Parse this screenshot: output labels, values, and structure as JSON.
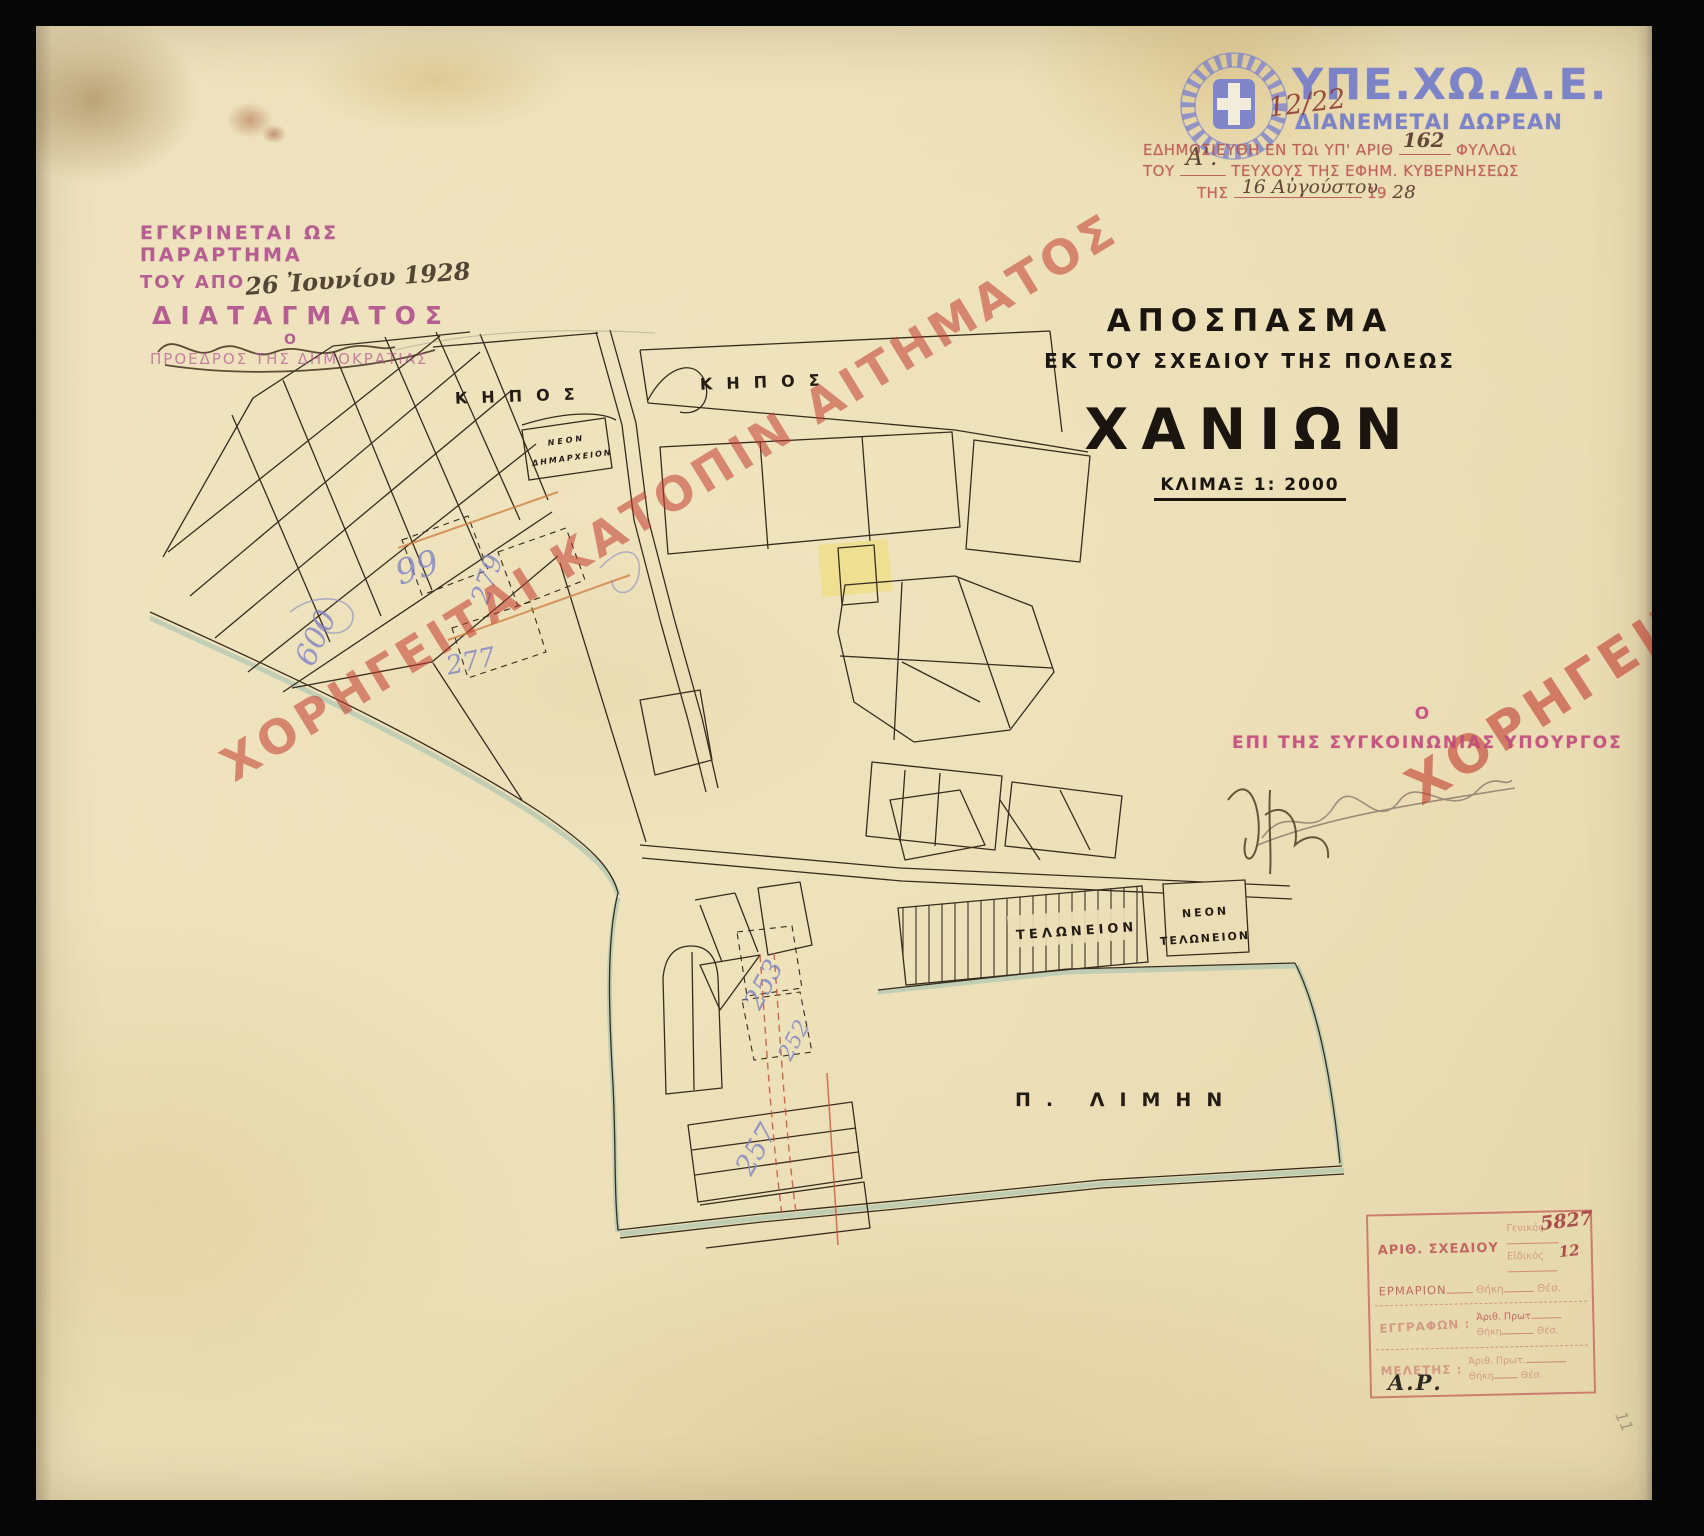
{
  "ministry": {
    "acronym": "ΥΠΕ.ΧΩ.Δ.Ε.",
    "free_distribution": "ΔΙΑΝΕΜΕΤΑΙ ΔΩΡΕΑΝ",
    "handwritten_ref": "12/22",
    "brand_color": "#7d83c7"
  },
  "publication_stamp": {
    "l1_a": "ΕΔΗΜΟΣΙΕΥΘΗ ΕΝ ΤΩι ΥΠ' ΑΡΙΘ",
    "l1_num": "162",
    "l1_b": "ΦΥΛΛΩι",
    "l2_a": "ΤΟΥ",
    "l2_entry": "Α'.",
    "l2_b": "ΤΕΥΧΟΥΣ ΤΗΣ ΕΦΗΜ. ΚΥΒΕΡΝΗΣΕΩΣ",
    "l3_a": "ΤΗΣ",
    "l3_date": "16 Αὐγούστου",
    "l3_b": "19",
    "l3_year": "28",
    "stamp_color": "#b85252"
  },
  "approval_stamp": {
    "l1": "ΕΓΚΡΙΝΕΤΑΙ ΩΣ ΠΑΡΑΡΤΗΜΑ",
    "l2_a": "ΤΟΥ ΑΠΟ",
    "l2_date": "26 Ἰουνίου 1928",
    "l3": "ΔΙΑΤΑΓΜΑΤΟΣ",
    "l4": "Ο",
    "l5": "ΠΡΟΕΔΡΟΣ ΤΗΣ ΔΗΜΟΚΡΑΤΙΑΣ",
    "stamp_color": "#b2538f"
  },
  "title_block": {
    "l1": "ΑΠΟΣΠΑΣΜΑ",
    "l2": "ΕΚ ΤΟΥ ΣΧΕΔΙΟΥ ΤΗΣ ΠΟΛΕΩΣ",
    "city": "ΧΑΝΙΩΝ",
    "scale": "ΚΛΙΜΑΞ 1: 2000"
  },
  "watermarks": {
    "left": "ΧΟΡΗΓΕΙΤΑΙ ΚΑΤΟΠΙΝ ΑΙΤΗΜΑΤΟΣ",
    "right": "ΧΟΡΗΓΕΙΤΑΙ Κ",
    "color": "#c23b2e"
  },
  "minister_stamp": {
    "l1": "Ο",
    "l2": "ΕΠΙ ΤΗΣ ΣΥΓΚΟΙΝΩΝΙΑΣ ΥΠΟΥΡΓΟΣ"
  },
  "map_labels": {
    "garden_left": "ΚΗΠΟΣ",
    "garden_right": "ΚΗΠΟΣ",
    "city_hall_1": "ΝΕΟΝ",
    "city_hall_2": "ΔΗΜΑΡΧΕΙΟΝ",
    "customs": "ΤΕΛΩΝΕΙΟΝ",
    "new_customs_1": "ΝΕΟΝ",
    "new_customs_2": "ΤΕΛΩΝΕΙΟΝ",
    "harbor": "Π.  ΛΙΜΗΝ"
  },
  "map_annotations": [
    "99",
    "600",
    "279",
    "277",
    "253",
    "252",
    "257"
  ],
  "registry_stamp": {
    "row1_label": "ΑΡΙΘ. ΣΧΕΔΙΟΥ",
    "general_label": "Γενικός",
    "general_value": "5827",
    "special_label": "Εἰδικός",
    "special_value": "12",
    "cabinet_label": "ΕΡΜΑΡΙΟΝ",
    "case_label": "Θήκη",
    "pos_label": "Θέσ.",
    "docs_label": "ΕΓΓΡΑΦΩΝ :",
    "protocol_label": "Ἀριθ. Πρωτ.",
    "study_label": "ΜΕΛΕΤΗΣ :"
  },
  "scan": {
    "corner_initials": "Α.Ρ.",
    "edge_note": "11"
  }
}
